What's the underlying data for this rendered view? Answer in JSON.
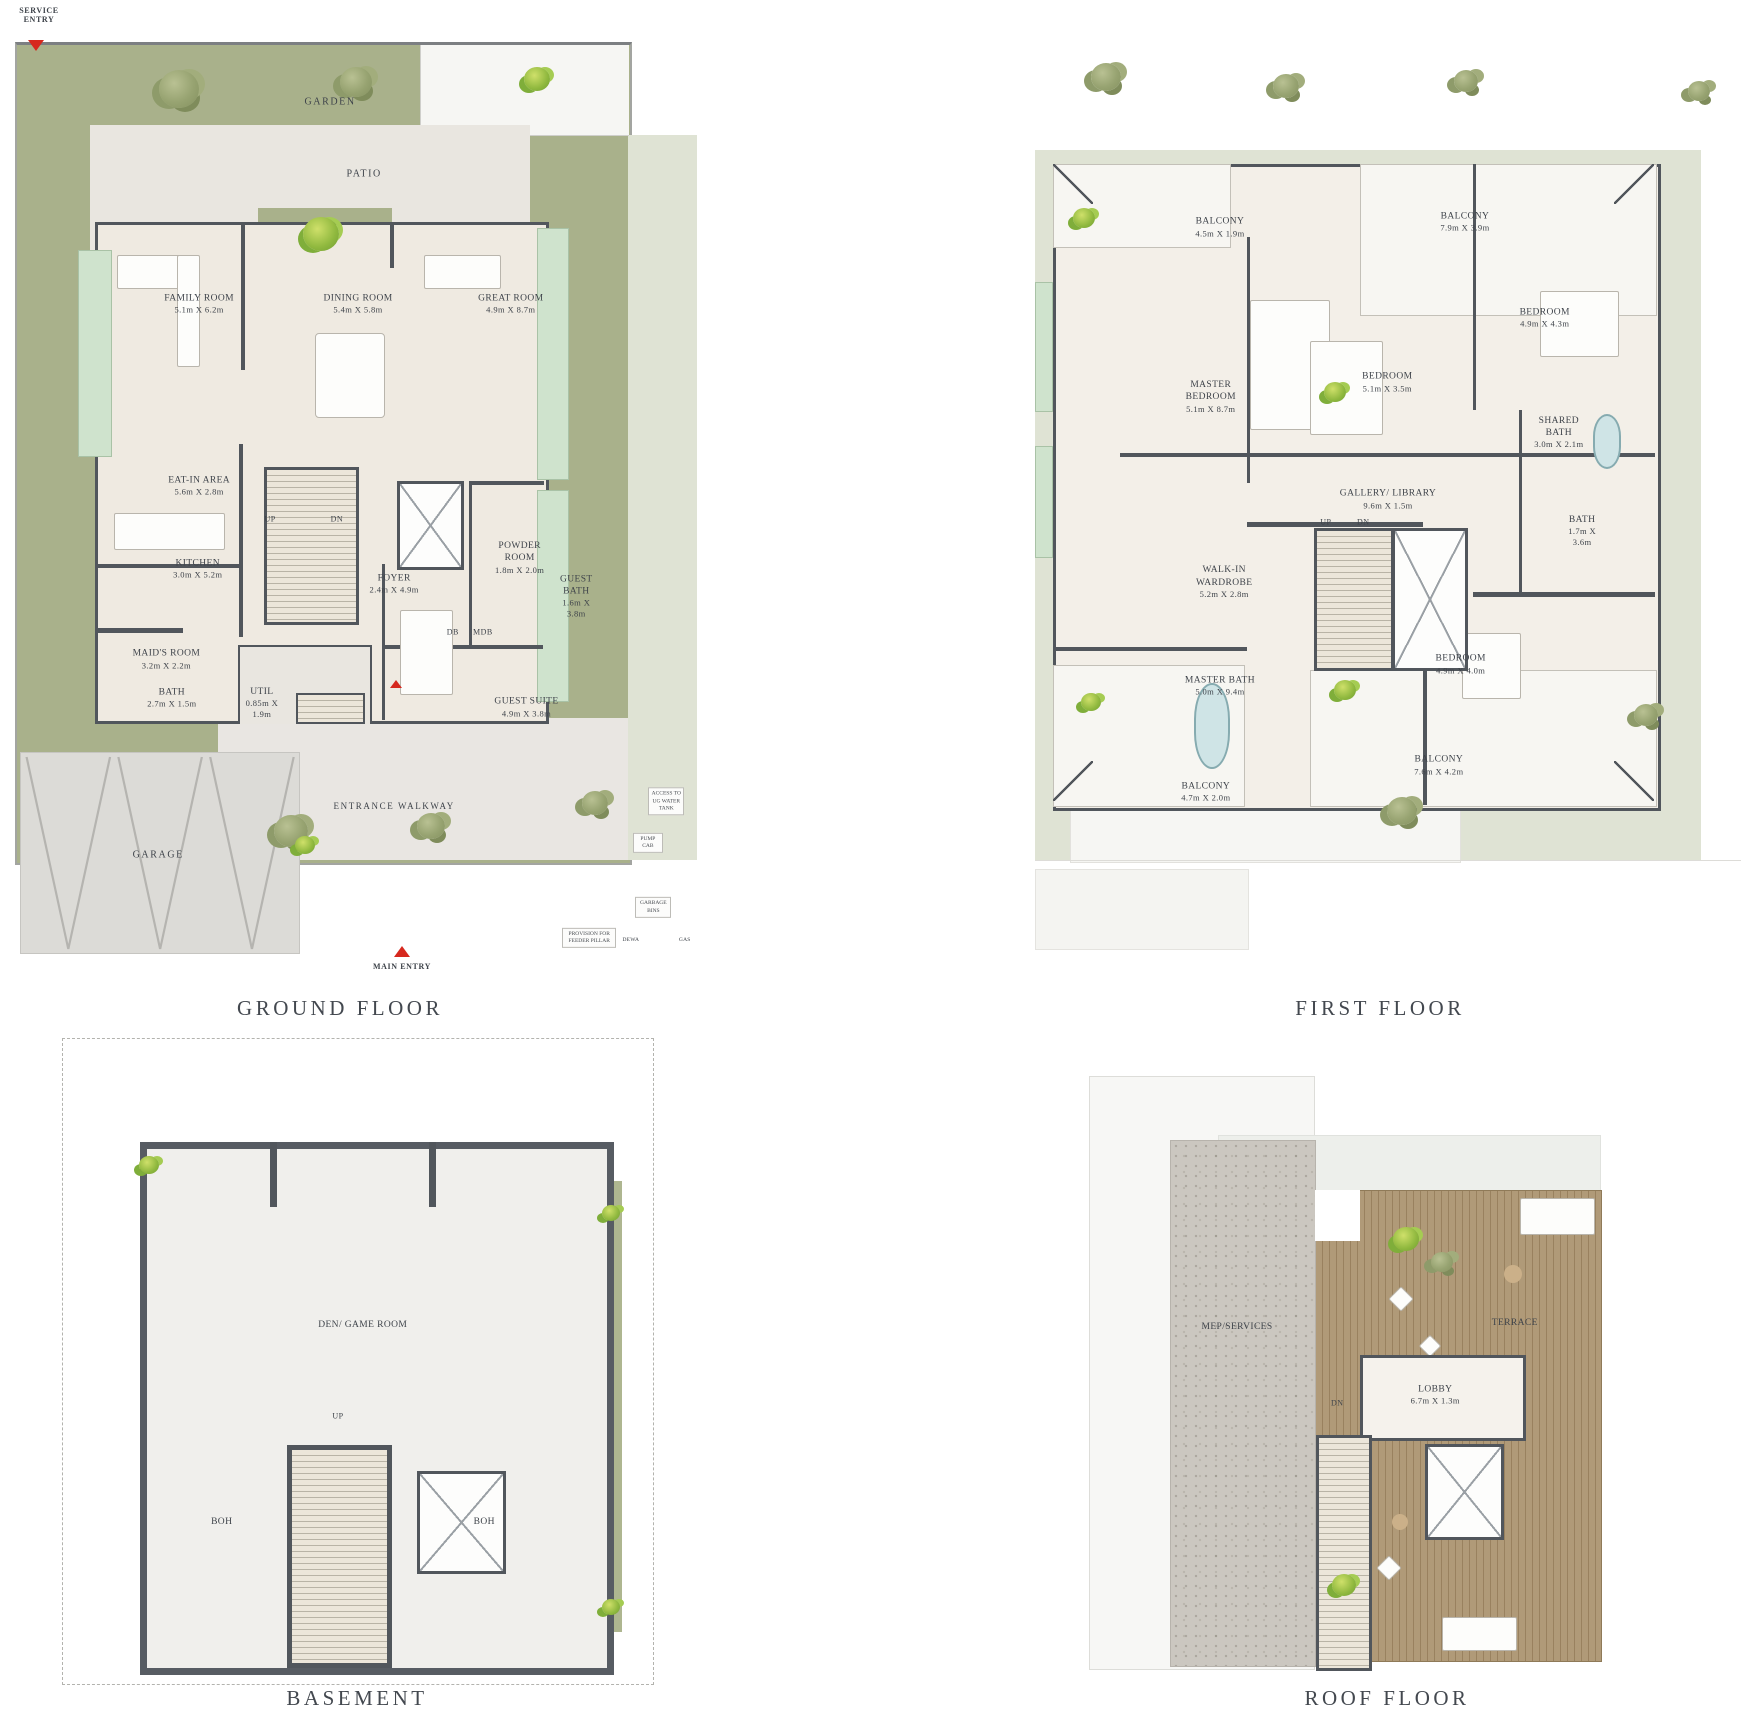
{
  "colors": {
    "garden_green": "#a9b18b",
    "pale_green": "#dfe3d4",
    "glass_green": "#cfe3cd",
    "wall_dark": "#51565c",
    "floor_beige": "#efeae1",
    "hardscape": "#e9e6e0",
    "deck_wood": "#a8906b",
    "mep_gray": "#cbc7c0",
    "entry_red": "#d6281e",
    "label_ink": "#3e434a"
  },
  "entries": {
    "service": "SERVICE ENTRY",
    "main": "MAIN ENTRY"
  },
  "floors": {
    "ground": {
      "title": "GROUND FLOOR",
      "areas": {
        "garden": "GARDEN",
        "patio": "PATIO",
        "garage": "GARAGE",
        "walkway": "ENTRANCE WALKWAY"
      },
      "rooms": [
        {
          "name": "FAMILY ROOM",
          "dims": "5.1m X 6.2m"
        },
        {
          "name": "DINING ROOM",
          "dims": "5.4m X 5.8m"
        },
        {
          "name": "GREAT ROOM",
          "dims": "4.9m X 8.7m"
        },
        {
          "name": "EAT-IN AREA",
          "dims": "5.6m X 2.8m"
        },
        {
          "name": "KITCHEN",
          "dims": "3.0m X 5.2m"
        },
        {
          "name": "FOYER",
          "dims": "2.4m X 4.9m"
        },
        {
          "name": "POWDER ROOM",
          "dims": "1.8m X 2.0m"
        },
        {
          "name": "GUEST BATH",
          "dims": "1.6m X 3.8m"
        },
        {
          "name": "MAID'S ROOM",
          "dims": "3.2m X 2.2m"
        },
        {
          "name": "BATH",
          "dims": "2.7m X 1.5m"
        },
        {
          "name": "UTIL",
          "dims": "0.85m X 1.9m"
        },
        {
          "name": "GUEST SUITE",
          "dims": "4.9m X 3.8m"
        }
      ],
      "markers": {
        "up": "UP",
        "dn": "DN",
        "db": "DB",
        "mdb": "MDB",
        "dewa": "DEWA",
        "gas": "GAS"
      },
      "annotations": [
        "ACCESS TO UG WATER TANK",
        "PUMP CAB",
        "GARBAGE BINS",
        "PROVISION FOR FEEDER PILLAR"
      ]
    },
    "first": {
      "title": "FIRST FLOOR",
      "rooms": [
        {
          "name": "BALCONY",
          "dims": "4.5m X 1.9m"
        },
        {
          "name": "BALCONY",
          "dims": "7.9m X 3.9m"
        },
        {
          "name": "MASTER BEDROOM",
          "dims": "5.1m X 8.7m"
        },
        {
          "name": "BEDROOM",
          "dims": "5.1m X 3.5m"
        },
        {
          "name": "BEDROOM",
          "dims": "4.9m X 4.3m"
        },
        {
          "name": "SHARED BATH",
          "dims": "3.0m X 2.1m"
        },
        {
          "name": "GALLERY/ LIBRARY",
          "dims": "9.6m X 1.5m"
        },
        {
          "name": "BATH",
          "dims": "1.7m X 3.6m"
        },
        {
          "name": "WALK-IN WARDROBE",
          "dims": "5.2m X 2.8m"
        },
        {
          "name": "MASTER BATH",
          "dims": "5.0m X 9.4m"
        },
        {
          "name": "BEDROOM",
          "dims": "4.9m X 4.0m"
        },
        {
          "name": "BALCONY",
          "dims": "4.7m X 2.0m"
        },
        {
          "name": "BALCONY",
          "dims": "7.6m X 4.2m"
        }
      ],
      "markers": {
        "up": "UP",
        "dn": "DN"
      }
    },
    "basement": {
      "title": "BASEMENT",
      "rooms": [
        {
          "name": "DEN/ GAME ROOM"
        },
        {
          "name": "BOH"
        },
        {
          "name": "BOH"
        }
      ],
      "markers": {
        "up": "UP"
      }
    },
    "roof": {
      "title": "ROOF FLOOR",
      "rooms": [
        {
          "name": "MEP/SERVICES"
        },
        {
          "name": "TERRACE"
        },
        {
          "name": "LOBBY",
          "dims": "6.7m X 1.3m"
        }
      ],
      "markers": {
        "dn": "DN"
      }
    }
  }
}
